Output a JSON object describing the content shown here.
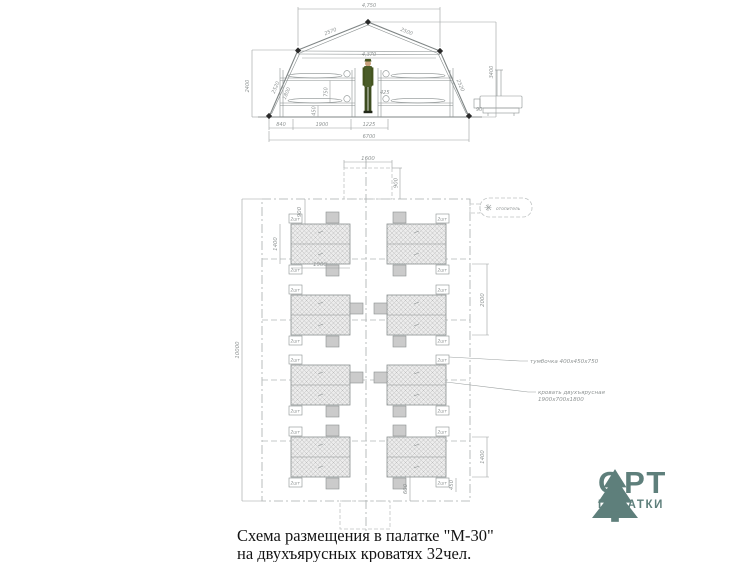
{
  "title": {
    "line1": "Схема размещения в палатке \"М-30\"",
    "line2": "на двухъярусных кроватях 32чел."
  },
  "logo": {
    "brand": "ОРТ",
    "sub": "ПАЛАТКИ",
    "color": "#5e7f7b"
  },
  "cross_section": {
    "dims": {
      "top_width": "4,750",
      "roof_left": "2570",
      "roof_right": "2500",
      "inner_width": "4,370",
      "height_left": "2400",
      "height_right": "3400",
      "wall_left": "2520",
      "wall_left_inner": "1800",
      "wall_right": "2520",
      "tier_gap": "750",
      "tier_low": "450",
      "center_gap": "425",
      "bottom_left": "840",
      "bed_length": "1900",
      "aisle": "1225",
      "total_width": "6700",
      "peg": "90"
    }
  },
  "plan": {
    "dims": {
      "length": "10000",
      "entrance_width": "1600",
      "entrance_depth": "900",
      "head_gap": "900",
      "block_width": "1400",
      "bed_length": "1900",
      "row_spacing": "2000",
      "block_width_bottom": "1400",
      "nightstand_width": "450",
      "foot_gap": "600"
    },
    "labels": {
      "nightstand_qty": "2шт",
      "heater": "отопитель",
      "callout_nightstand": "тумбочка 400х450х750",
      "callout_bed_1": "кровать двухъярусная",
      "callout_bed_2": "1900х700х1800"
    }
  }
}
